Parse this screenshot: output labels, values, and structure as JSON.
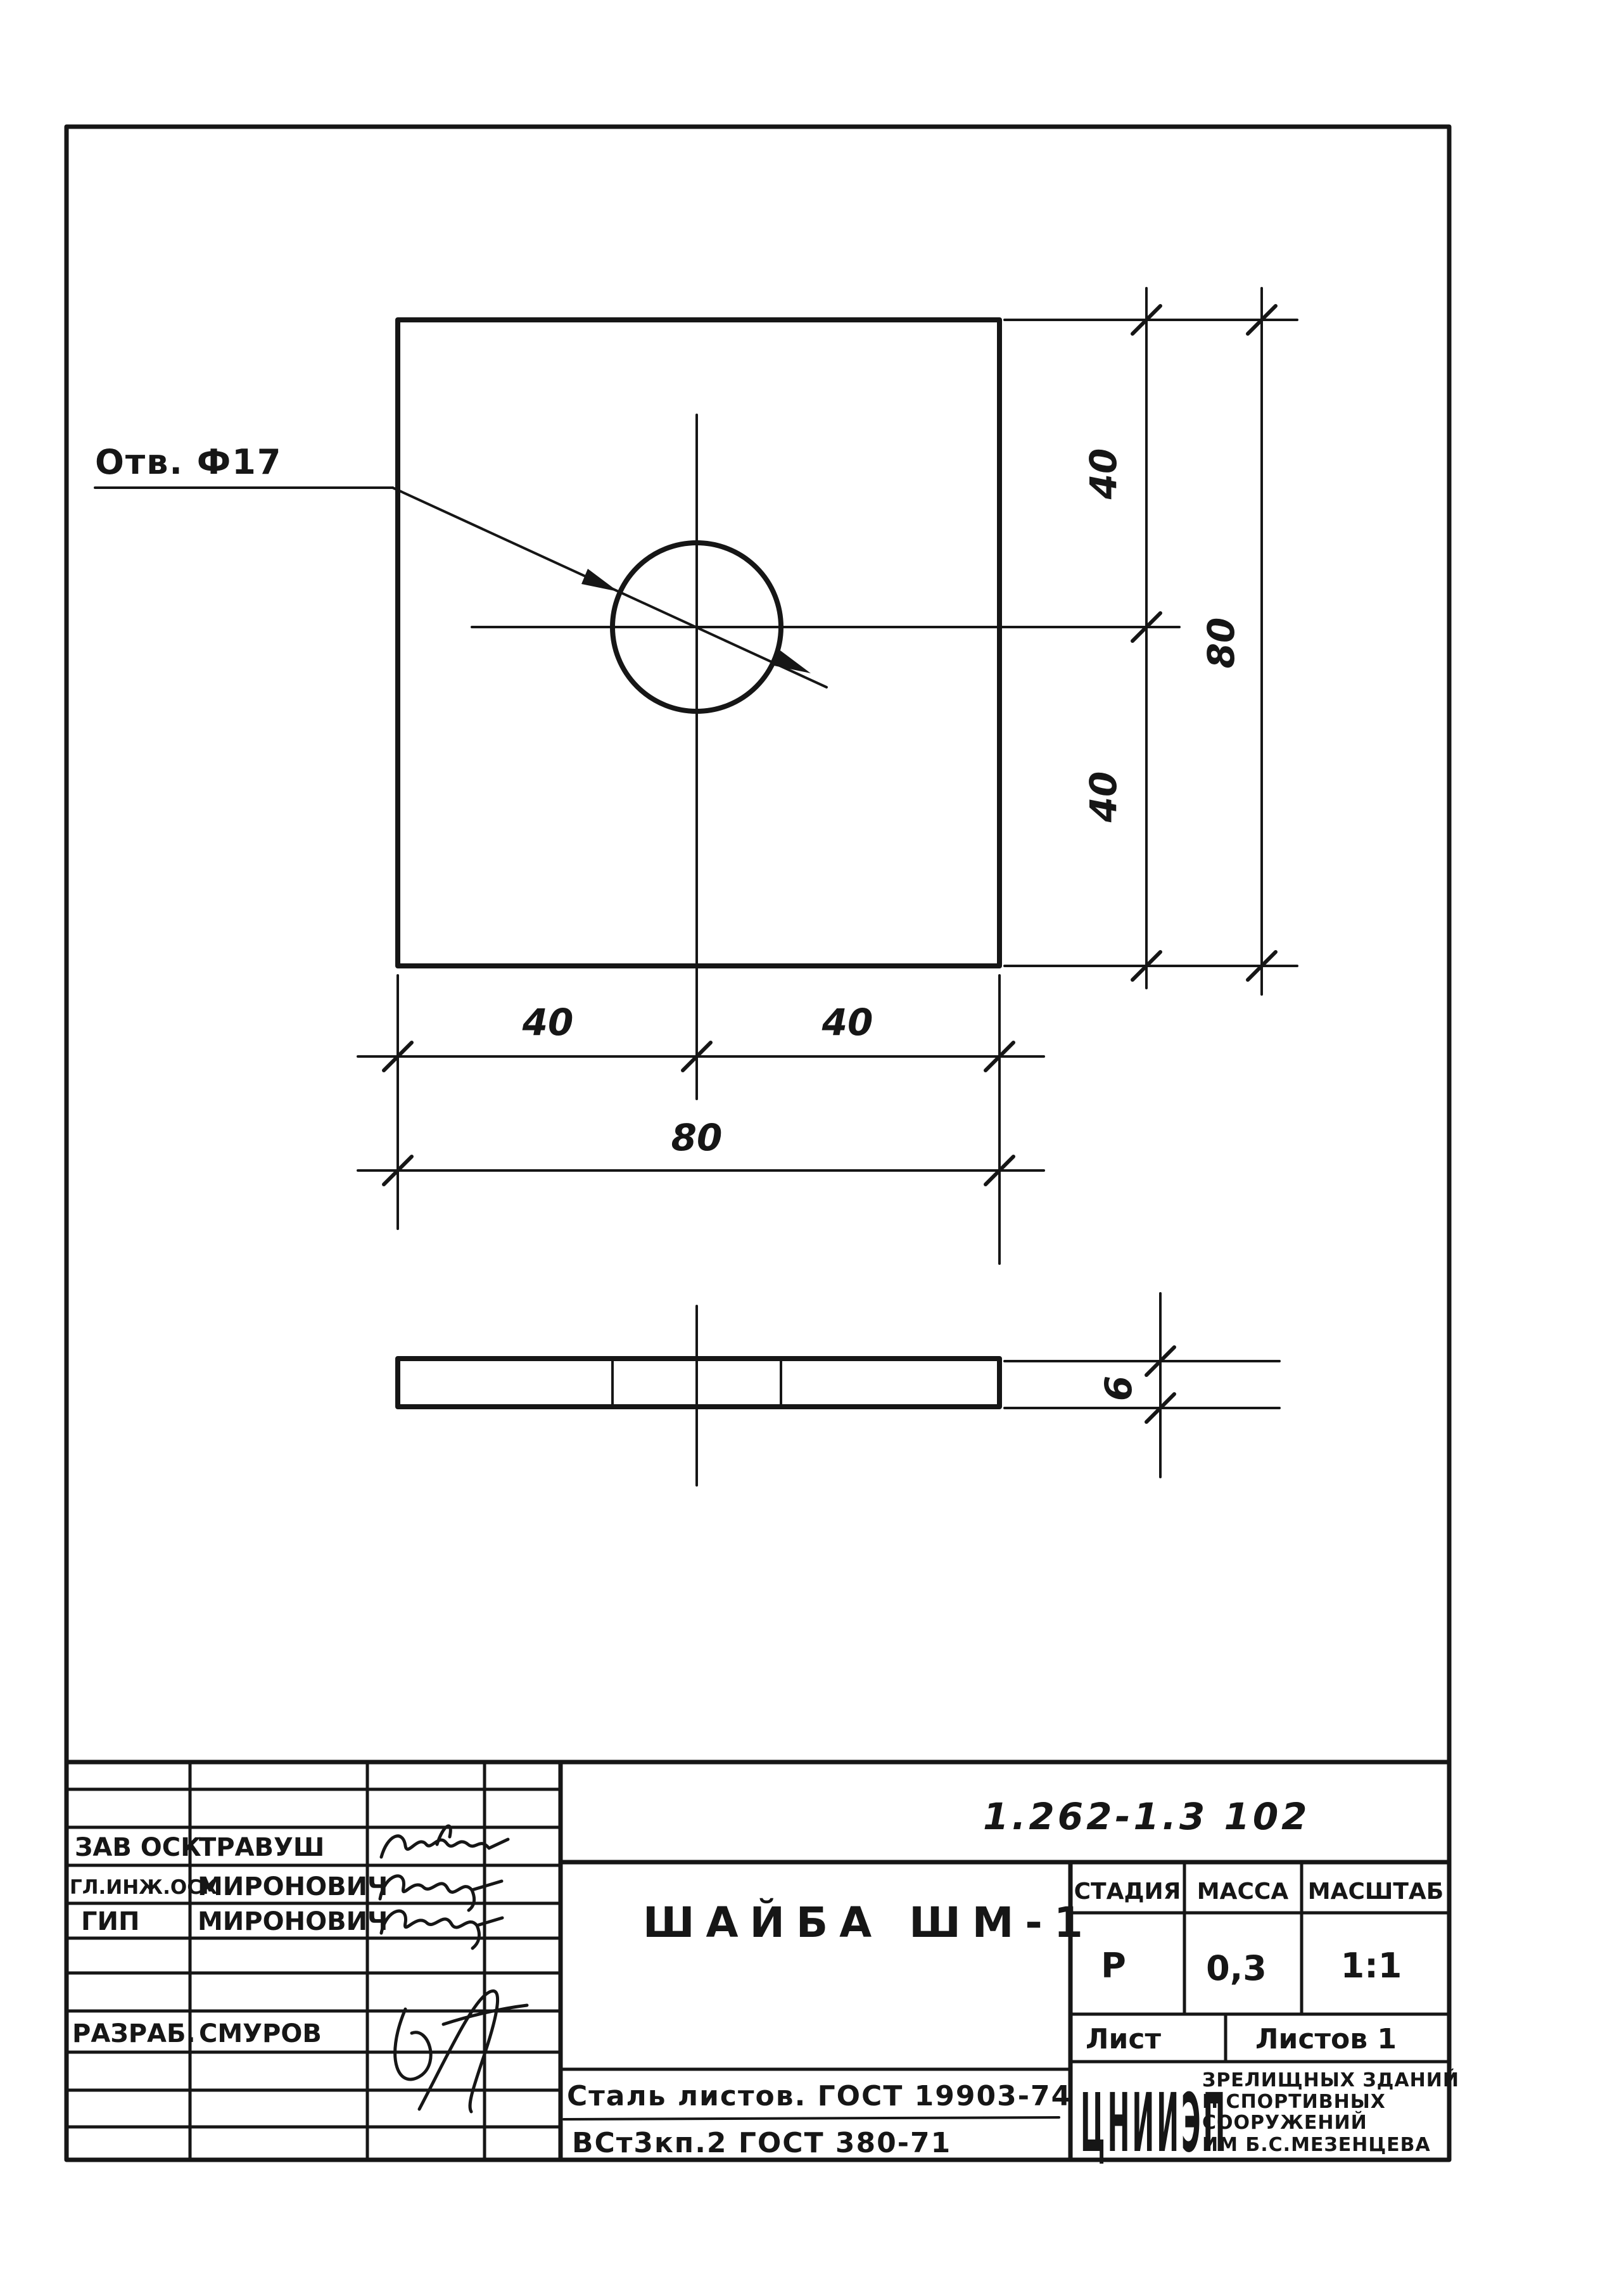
{
  "colors": {
    "ink": "#161616",
    "paper": "#ffffff"
  },
  "plan_view": {
    "hole_label": "Отв. Ф17",
    "dims": {
      "right_upper": "40",
      "right_lower": "40",
      "right_overall": "80",
      "bottom_left": "40",
      "bottom_right": "40",
      "bottom_overall": "80"
    }
  },
  "side_view": {
    "thickness": "6"
  },
  "title_block": {
    "doc_number": "1.262-1.3 102",
    "part_title": "ШАЙБА ШМ-1",
    "material_line1": "Сталь листов. ГОСТ 19903-74",
    "material_line2": "ВСт3кп.2      ГОСТ 380-71",
    "stage": {
      "header": "СТАДИЯ",
      "value": "Р"
    },
    "mass": {
      "header": "МАССА",
      "value": "0,3"
    },
    "scale": {
      "header": "МАСШТАБ",
      "value": "1:1"
    },
    "sheet_label": "Лист",
    "sheets_label": "Листов 1",
    "org": {
      "logo": "ЦНИИЭП",
      "line1": "ЗРЕЛИЩНЫХ ЗДАНИЙ",
      "line2": "И СПОРТИВНЫХ",
      "line3": "СООРУЖЕНИЙ",
      "line4": "ИМ Б.С.МЕЗЕНЦЕВА"
    },
    "roles": [
      {
        "role": "ЗАВ ОСК",
        "name": "ТРАВУШ"
      },
      {
        "role": "ГЛ.ИНЖ.ОСК",
        "name": "МИРОНОВИЧ"
      },
      {
        "role": "ГИП",
        "name": "МИРОНОВИЧ"
      },
      {
        "role": "РАЗРАБ.",
        "name": "СМУРОВ"
      }
    ]
  }
}
